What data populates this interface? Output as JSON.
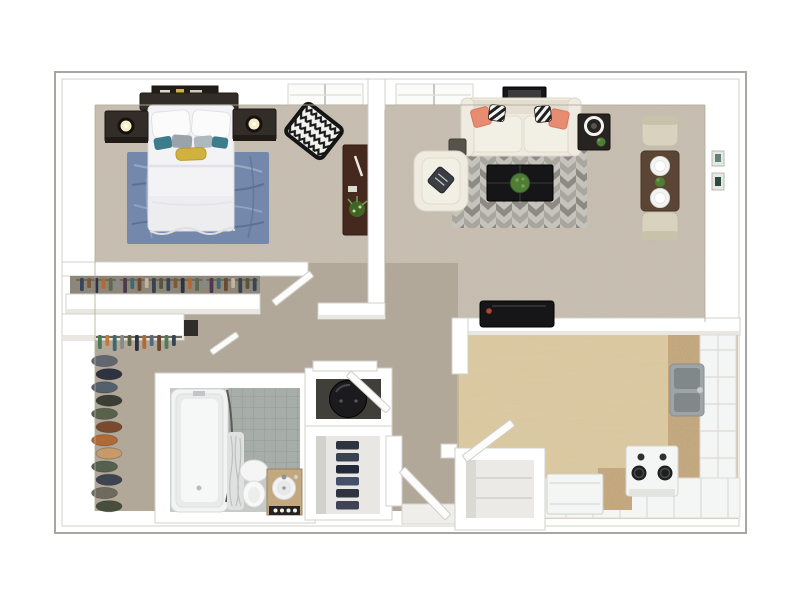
{
  "scene": {
    "title": "apartment-3d-floor-plan",
    "view": "top-down 3d dollhouse rendering, one-bedroom one-bath apartment, no visible text",
    "rooms": [
      {
        "name": "bedroom",
        "floor": "beige carpet",
        "furniture": [
          "queen-bed-white-bedding",
          "dark-headboard",
          "picture-ledge",
          "nightstand-left-with-lamp",
          "nightstand-right-with-lamp",
          "blue-area-rug",
          "chevron-accent-chair",
          "dark-wood-desk-with-plant",
          "window"
        ]
      },
      {
        "name": "living-dining-room",
        "floor": "beige carpet",
        "furniture": [
          "cream-sofa-with-coral-and-striped-pillows",
          "black-side-table",
          "cube-ottoman",
          "cream-accent-chair",
          "geometric-gray-rug",
          "black-coffee-table-with-plant",
          "dining-table-with-two-place-settings",
          "two-dining-chairs",
          "two-wall-pictures",
          "wall-art",
          "window",
          "tv-console-on-half-wall"
        ]
      },
      {
        "name": "bedroom-reach-in-closet",
        "contents": [
          "hanging-clothes-rod"
        ]
      },
      {
        "name": "walk-in-closet",
        "contents": [
          "white-shelf",
          "hanging-clothes",
          "stacked-hats-and-shoes"
        ]
      },
      {
        "name": "bathroom",
        "floor": "gray tile",
        "fixtures": [
          "bathtub-with-shower-curtain",
          "toilet",
          "granite-vanity-with-round-sink"
        ]
      },
      {
        "name": "utility-closet",
        "contents": [
          "water-heater"
        ]
      },
      {
        "name": "linen-closet",
        "contents": [
          "folded-linens"
        ]
      },
      {
        "name": "kitchen",
        "floor": "light wood",
        "fixtures": [
          "double-basin-sink",
          "range-with-burners",
          "dishwasher",
          "tile-counters",
          "granite-countertop-strips",
          "pantry-closet"
        ]
      },
      {
        "name": "entry",
        "contents": [
          "front-door-open"
        ]
      }
    ],
    "doors_open": [
      "bedroom-door",
      "walk-in-closet-door",
      "utility-closet-door",
      "pantry-door",
      "entry-door"
    ]
  },
  "colors": {
    "frame": "#a6a6a3",
    "wall": "#ffffff",
    "wall_edge": "#d2d0ca",
    "wall_shadow": "#bdb6a9",
    "carpet": "#c8bfb2",
    "carpet_dark": "#b2a899",
    "wood": "#dccaa3",
    "tile": "#a7ada8",
    "tile_line": "#949b95",
    "tile_light": "#c7cac6",
    "granite": "#c9ad83",
    "rug_blue": "#7488ab",
    "rug_blue_light": "#9fb1ce",
    "rug_blue_dark": "#5c7095",
    "rug_base": "#c6c3bc",
    "rug_dark": "#8d8a84",
    "rug_mid": "#a9a69f",
    "sofa": "#efebe0",
    "sofa_shade": "#e3ded0",
    "sofa_edge": "#d9d4c4",
    "coral": "#e78b71",
    "ink": "#161618",
    "espresso": "#332d29",
    "espresso_dark": "#211c18",
    "desk": "#45291e",
    "dining": "#5b4636",
    "chair": "#d8d2bf",
    "chair_shade": "#c9c2ab",
    "teal": "#3c7c8c",
    "mustard": "#d2b23e",
    "pillow_gray": "#9aa2aa",
    "pillow_slate": "#3a3d42",
    "plant": "#4f7d36",
    "plant_light": "#74a24e",
    "fixture": "#f4f5f5",
    "steel": "#9fa4a6",
    "sink": "#81888a",
    "heater": "#1b1b1d",
    "closet_int": "#8d8679",
    "closet_dark": "#413f3a",
    "linen": "#e8e7e3"
  },
  "series": {
    "closet_clothes": {
      "kind": "hang",
      "x0": 80,
      "step": 7.2,
      "count": 25,
      "y": 278,
      "w": 3.8,
      "heights": [
        13,
        10,
        15,
        11
      ],
      "colors": [
        "#36455c",
        "#7a5a3a",
        "#2e3340",
        "#b06a36",
        "#5d6a52",
        "#87898b",
        "#4a3a4e",
        "#3e6a6e",
        "#6a4a32",
        "#c2b49a",
        "#39424e",
        "#565640"
      ]
    },
    "walkin_clothes": {
      "kind": "hang",
      "x0": 98,
      "step": 7.4,
      "count": 11,
      "y": 335,
      "w": 3.8,
      "heights": [
        14,
        11,
        16
      ],
      "colors": [
        "#4a7a52",
        "#c07a3a",
        "#3e6a6e",
        "#8a8a86",
        "#5d5d42",
        "#2e3340",
        "#b06a36",
        "#566a7a",
        "#6a4a32",
        "#4f7a5c",
        "#39424e"
      ]
    },
    "hat_stack": {
      "kind": "stack",
      "x": 106,
      "y0": 361,
      "step": 13.2,
      "count": 12,
      "rx": 13,
      "ry": 5.6,
      "wobble": 3,
      "colors": [
        "#62666e",
        "#2e3340",
        "#55606e",
        "#3a3e34",
        "#58624a",
        "#7a4a2e",
        "#b06a36",
        "#c79a6a",
        "#55604e",
        "#3e4452",
        "#6e6a5e",
        "#474f3c"
      ]
    },
    "linen_stack": {
      "kind": "bars",
      "x": 336,
      "y0": 441,
      "step": 12,
      "count": 6,
      "w": 23,
      "h": 8.5,
      "colors": [
        "#2d3440",
        "#3a4150",
        "#23283a",
        "#44506a",
        "#2d3440",
        "#3e4456"
      ]
    }
  }
}
